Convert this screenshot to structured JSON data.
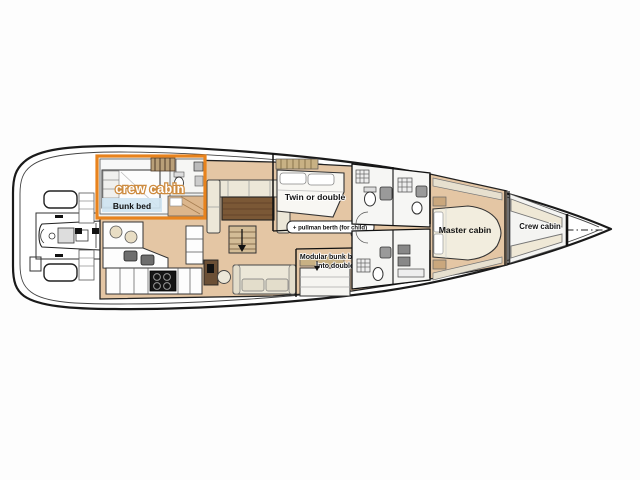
{
  "diagram": {
    "type": "yacht-interior-layout-plan",
    "labels": {
      "aft_crew_cabin": "crew cabin",
      "bunk_bed": "Bunk bed",
      "twin_or_double": "Twin or double",
      "pullman_berth": "+ pullman berth (for child)",
      "modular_bunk_line1": "Modular bunk bed",
      "modular_bunk_line2": "into double",
      "master_cabin": "Master cabin",
      "bow_crew_cabin": "Crew cabin"
    },
    "colors": {
      "highlight": "#e8831d",
      "floor": "#e4c6a4",
      "wood_table": "#7b5836",
      "sofa": "#ece7d8",
      "bunk_label_bg": "#cfe4f1",
      "hull_line": "#1a1a1a",
      "cabinet_wood": "#c8b184",
      "bed_white": "#f8f7f3"
    }
  }
}
